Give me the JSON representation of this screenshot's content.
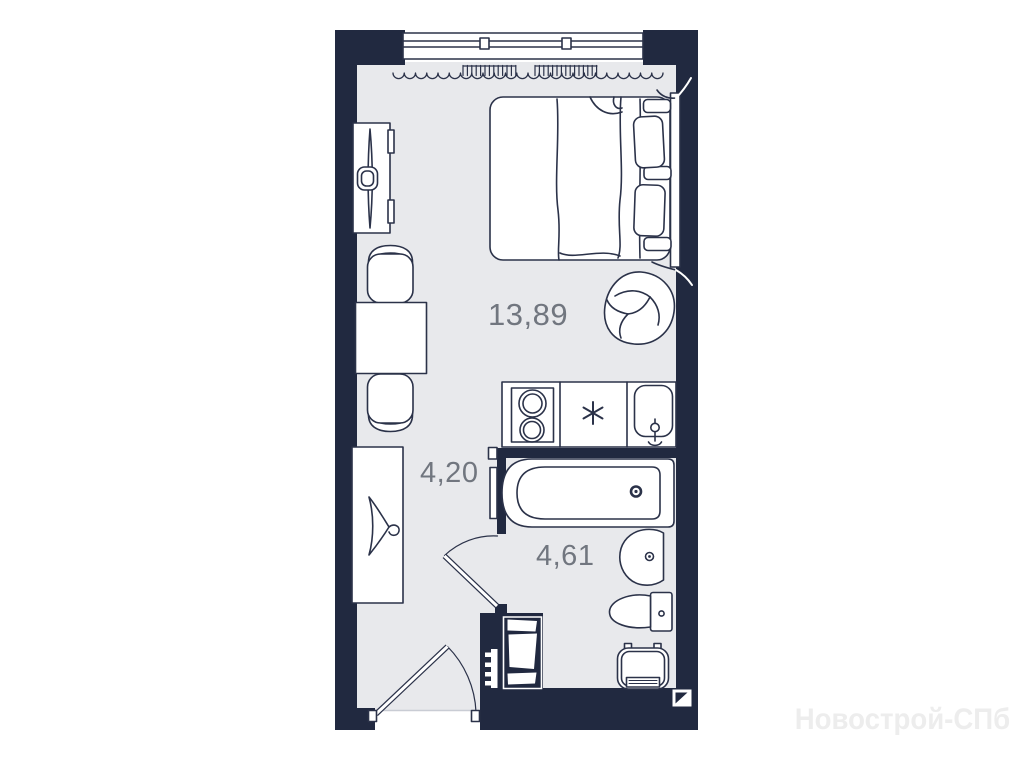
{
  "plan": {
    "watermark": "Новострой-СПб",
    "rooms": [
      {
        "name": "living-kitchen",
        "area": "13,89"
      },
      {
        "name": "hallway",
        "area": "4,20"
      },
      {
        "name": "bathroom",
        "area": "4,61"
      }
    ],
    "colors": {
      "wall": "#212940",
      "floor": "#e8e9ec",
      "outline": "#2b3249",
      "area_label": "#71767f",
      "watermark": "#ededed"
    },
    "furniture_icons": [
      "window-icon",
      "curtain-icon",
      "radiator-icon",
      "double-bed-icon",
      "pillow-icon",
      "pouf-icon",
      "tv-stand-icon",
      "dining-table-icon",
      "chair-icon",
      "wardrobe-icon",
      "hanger-icon",
      "hob-icon",
      "kitchen-sink-icon",
      "bathtub-icon",
      "washbasin-icon",
      "toilet-icon",
      "washing-machine-icon",
      "vent-shaft-icon",
      "entrance-door-icon",
      "bathroom-door-icon",
      "logo-mark-icon"
    ]
  }
}
